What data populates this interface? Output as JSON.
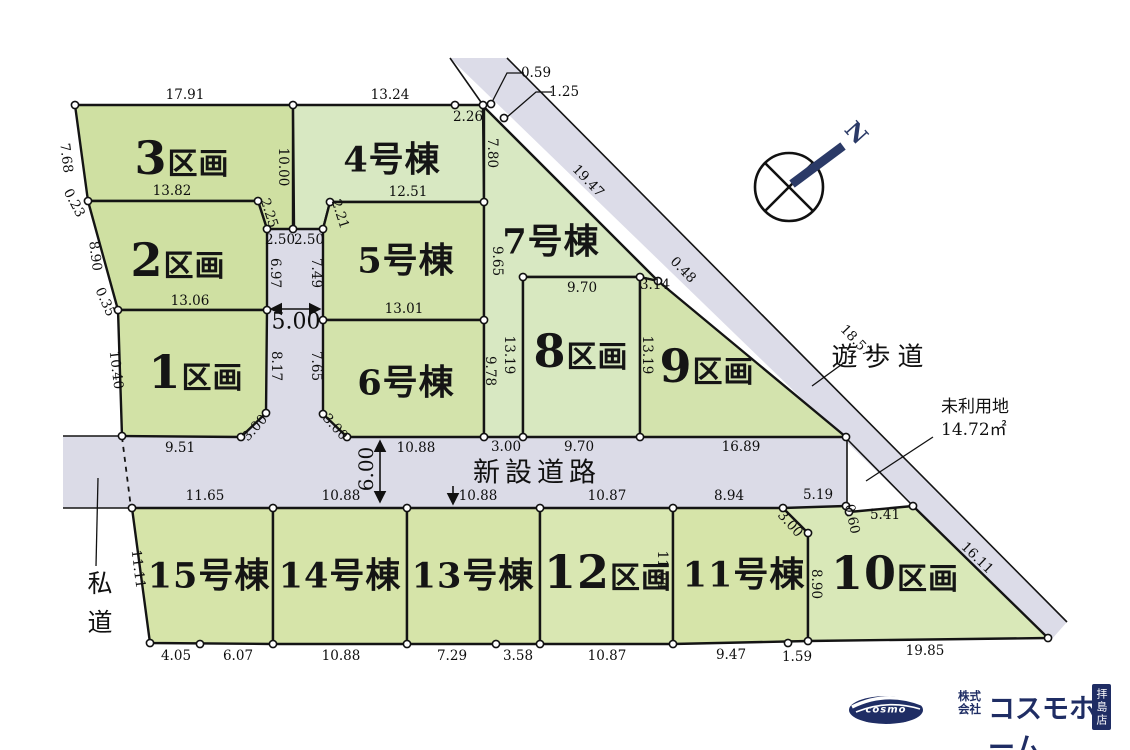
{
  "diagram": {
    "roads": {
      "new_road_label": "新設道路",
      "walkway_label": "遊歩道",
      "private_road_label": "私道"
    },
    "unused_land": {
      "line1": "未利用地",
      "line2": "14.72㎡"
    },
    "north_label": "N",
    "lots": [
      {
        "id": "lot-3",
        "number": "3",
        "suffix": "区画",
        "type": "kukaku",
        "x": 182,
        "y": 158
      },
      {
        "id": "lot-2",
        "number": "2",
        "suffix": "区画",
        "type": "kukaku",
        "x": 178,
        "y": 260
      },
      {
        "id": "lot-1",
        "number": "1",
        "suffix": "区画",
        "type": "kukaku",
        "x": 196,
        "y": 372
      },
      {
        "id": "lot-4",
        "number": "4",
        "suffix": "号棟",
        "type": "goto",
        "x": 392,
        "y": 157
      },
      {
        "id": "lot-5",
        "number": "5",
        "suffix": "号棟",
        "type": "goto",
        "x": 406,
        "y": 258
      },
      {
        "id": "lot-6",
        "number": "6",
        "suffix": "号棟",
        "type": "goto",
        "x": 406,
        "y": 380
      },
      {
        "id": "lot-7",
        "number": "7",
        "suffix": "号棟",
        "type": "goto",
        "x": 551,
        "y": 239
      },
      {
        "id": "lot-8",
        "number": "8",
        "suffix": "区画",
        "type": "kukaku",
        "x": 581,
        "y": 351
      },
      {
        "id": "lot-9",
        "number": "9",
        "suffix": "区画",
        "type": "kukaku",
        "x": 707,
        "y": 366
      },
      {
        "id": "lot-15",
        "number": "15",
        "suffix": "号棟",
        "type": "goto",
        "x": 209,
        "y": 573
      },
      {
        "id": "lot-14",
        "number": "14",
        "suffix": "号棟",
        "type": "goto",
        "x": 340,
        "y": 573
      },
      {
        "id": "lot-13",
        "number": "13",
        "suffix": "号棟",
        "type": "goto",
        "x": 473,
        "y": 573
      },
      {
        "id": "lot-12",
        "number": "12",
        "suffix": "区画",
        "type": "kukaku",
        "x": 608,
        "y": 572
      },
      {
        "id": "lot-11",
        "number": "11",
        "suffix": "号棟",
        "type": "goto",
        "x": 744,
        "y": 572
      },
      {
        "id": "lot-10",
        "number": "10",
        "suffix": "区画",
        "type": "kukaku",
        "x": 895,
        "y": 573
      }
    ],
    "dimensions": [
      {
        "v": "17.91",
        "x": 185,
        "y": 95,
        "r": 0
      },
      {
        "v": "13.24",
        "x": 390,
        "y": 95,
        "r": 0
      },
      {
        "v": "2.26",
        "x": 468,
        "y": 117,
        "r": 0
      },
      {
        "v": "0.59",
        "x": 536,
        "y": 73,
        "r": 0
      },
      {
        "v": "1.25",
        "x": 564,
        "y": 92,
        "r": 0
      },
      {
        "v": "7.68",
        "x": 66,
        "y": 158,
        "r": 83
      },
      {
        "v": "0.23",
        "x": 74,
        "y": 203,
        "r": 62
      },
      {
        "v": "10.00",
        "x": 283,
        "y": 167,
        "r": 90
      },
      {
        "v": "13.82",
        "x": 172,
        "y": 191,
        "r": 0
      },
      {
        "v": "2.25",
        "x": 269,
        "y": 213,
        "r": 72
      },
      {
        "v": "2.21",
        "x": 340,
        "y": 214,
        "r": 72
      },
      {
        "v": "12.51",
        "x": 408,
        "y": 192,
        "r": 0
      },
      {
        "v": "2.50",
        "x": 280,
        "y": 240,
        "r": 0
      },
      {
        "v": "2.50",
        "x": 309,
        "y": 240,
        "r": 0
      },
      {
        "v": "7.80",
        "x": 492,
        "y": 153,
        "r": 90
      },
      {
        "v": "19.47",
        "x": 588,
        "y": 181,
        "r": 46
      },
      {
        "v": "8.90",
        "x": 95,
        "y": 256,
        "r": 83
      },
      {
        "v": "6.97",
        "x": 275,
        "y": 273,
        "r": 90
      },
      {
        "v": "7.49",
        "x": 316,
        "y": 273,
        "r": 90
      },
      {
        "v": "9.65",
        "x": 497,
        "y": 261,
        "r": 90
      },
      {
        "v": "0.35",
        "x": 105,
        "y": 302,
        "r": 66
      },
      {
        "v": "13.06",
        "x": 190,
        "y": 301,
        "r": 0
      },
      {
        "v": "5.00",
        "x": 296,
        "y": 322,
        "r": 0,
        "s": 22
      },
      {
        "v": "13.01",
        "x": 404,
        "y": 309,
        "r": 0
      },
      {
        "v": "9.70",
        "x": 582,
        "y": 288,
        "r": 0
      },
      {
        "v": "3.14",
        "x": 655,
        "y": 285,
        "r": 0
      },
      {
        "v": "0.48",
        "x": 683,
        "y": 270,
        "r": 46
      },
      {
        "v": "18.57",
        "x": 856,
        "y": 341,
        "r": 46
      },
      {
        "v": "10.40",
        "x": 116,
        "y": 370,
        "r": 83
      },
      {
        "v": "8.17",
        "x": 276,
        "y": 366,
        "r": 90
      },
      {
        "v": "7.65",
        "x": 316,
        "y": 366,
        "r": 90
      },
      {
        "v": "13.19",
        "x": 509,
        "y": 355,
        "r": 90
      },
      {
        "v": "13.19",
        "x": 647,
        "y": 355,
        "r": 90
      },
      {
        "v": "9.78",
        "x": 490,
        "y": 371,
        "r": 90
      },
      {
        "v": "3.00",
        "x": 255,
        "y": 428,
        "r": -48
      },
      {
        "v": "3.00",
        "x": 335,
        "y": 427,
        "r": 48
      },
      {
        "v": "9.51",
        "x": 180,
        "y": 448,
        "r": 0
      },
      {
        "v": "10.88",
        "x": 416,
        "y": 448,
        "r": 0
      },
      {
        "v": "3.00",
        "x": 506,
        "y": 447,
        "r": 0
      },
      {
        "v": "9.70",
        "x": 579,
        "y": 447,
        "r": 0
      },
      {
        "v": "16.89",
        "x": 741,
        "y": 447,
        "r": 0
      },
      {
        "v": "6.00",
        "x": 366,
        "y": 469,
        "r": -90,
        "s": 20
      },
      {
        "v": "11.65",
        "x": 205,
        "y": 496,
        "r": 0
      },
      {
        "v": "10.88",
        "x": 341,
        "y": 496,
        "r": 0
      },
      {
        "v": "10.88",
        "x": 478,
        "y": 496,
        "r": 0
      },
      {
        "v": "10.87",
        "x": 607,
        "y": 496,
        "r": 0
      },
      {
        "v": "8.94",
        "x": 729,
        "y": 496,
        "r": 0
      },
      {
        "v": "5.19",
        "x": 818,
        "y": 495,
        "r": 0
      },
      {
        "v": "0.60",
        "x": 852,
        "y": 519,
        "r": 78
      },
      {
        "v": "5.41",
        "x": 885,
        "y": 515,
        "r": 0
      },
      {
        "v": "3.00",
        "x": 790,
        "y": 524,
        "r": 48
      },
      {
        "v": "11.11",
        "x": 138,
        "y": 569,
        "r": 83
      },
      {
        "v": "11.04",
        "x": 662,
        "y": 570,
        "r": 90
      },
      {
        "v": "8.90",
        "x": 816,
        "y": 584,
        "r": 90
      },
      {
        "v": "16.11",
        "x": 977,
        "y": 558,
        "r": 44
      },
      {
        "v": "4.05",
        "x": 176,
        "y": 656,
        "r": 0
      },
      {
        "v": "6.07",
        "x": 238,
        "y": 656,
        "r": 0
      },
      {
        "v": "10.88",
        "x": 341,
        "y": 656,
        "r": 0
      },
      {
        "v": "7.29",
        "x": 452,
        "y": 656,
        "r": 0
      },
      {
        "v": "3.58",
        "x": 518,
        "y": 656,
        "r": 0
      },
      {
        "v": "10.87",
        "x": 607,
        "y": 656,
        "r": 0
      },
      {
        "v": "9.47",
        "x": 731,
        "y": 655,
        "r": 0
      },
      {
        "v": "1.59",
        "x": 797,
        "y": 657,
        "r": 0
      },
      {
        "v": "19.85",
        "x": 925,
        "y": 651,
        "r": 0
      }
    ],
    "logo": {
      "cosmo": "cosmo",
      "company_prefix_line1": "株式",
      "company_prefix_line2": "会社",
      "name": "コスモホーム",
      "branch": "拝島店"
    }
  }
}
